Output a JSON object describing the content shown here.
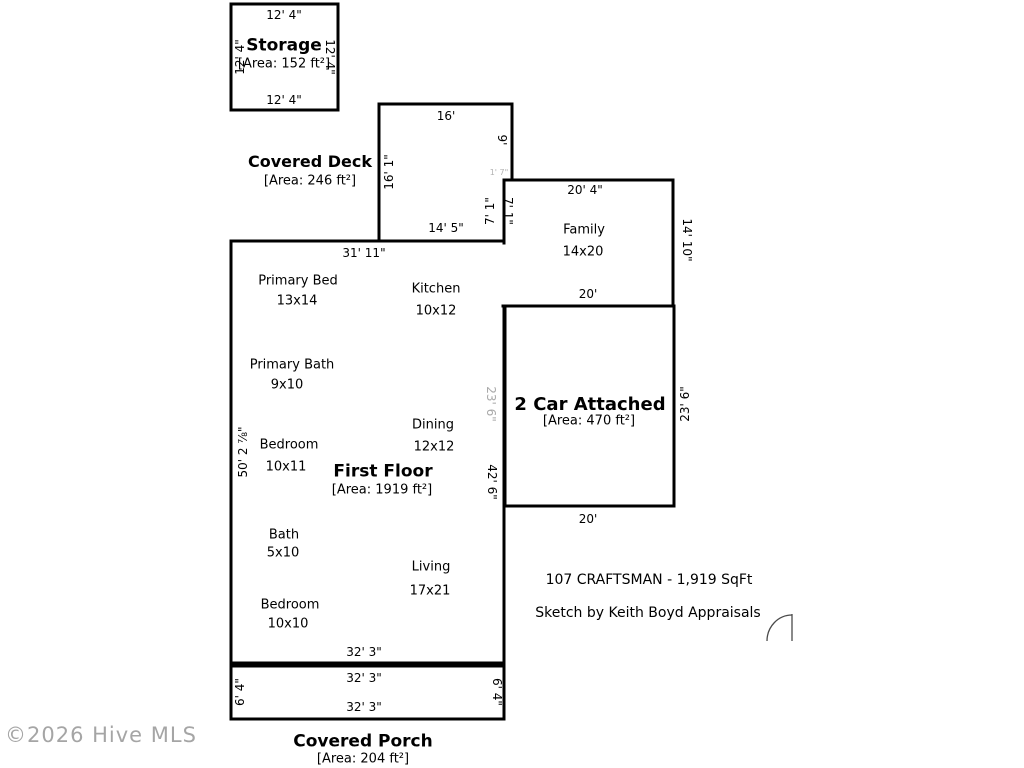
{
  "rooms": {
    "storage": {
      "name": "Storage",
      "area": "[Area: 152 ft²]"
    },
    "deck": {
      "name": "Covered Deck",
      "area": "[Area: 246 ft²]"
    },
    "first_floor": {
      "name": "First Floor",
      "area": "[Area: 1919 ft²]"
    },
    "garage": {
      "name": "2 Car Attached",
      "area": "[Area: 470 ft²]"
    },
    "porch": {
      "name": "Covered Porch",
      "area": "[Area: 204 ft²]"
    },
    "primary_bed": {
      "name": "Primary Bed",
      "size": "13x14"
    },
    "kitchen": {
      "name": "Kitchen",
      "size": "10x12"
    },
    "primary_bath": {
      "name": "Primary Bath",
      "size": "9x10"
    },
    "bedroom1": {
      "name": "Bedroom",
      "size": "10x11"
    },
    "dining": {
      "name": "Dining",
      "size": "12x12"
    },
    "bath": {
      "name": "Bath",
      "size": "5x10"
    },
    "living": {
      "name": "Living",
      "size": "17x21"
    },
    "bedroom2": {
      "name": "Bedroom",
      "size": "10x10"
    },
    "family": {
      "name": "Family",
      "size": "14x20"
    }
  },
  "dims": {
    "storage_top": "12' 4\"",
    "storage_bottom": "12' 4\"",
    "storage_left": "12' 4\"",
    "storage_right": "12' 4\"",
    "deck_top": "16'",
    "deck_left": "16' 1\"",
    "deck_bottom": "14' 5\"",
    "deck_right": "9'",
    "notch": "1' 7\"",
    "step_left": "7' 1\"",
    "step_right": "7' 1\"",
    "house_top": "31' 11\"",
    "house_left": "50' 2 ⅞\"",
    "house_bottom": "32' 3\"",
    "house_right": "42' 6\"",
    "family_top": "20' 4\"",
    "family_right": "14' 10\"",
    "family_bottom": "20'",
    "garage_left": "23' 6\"",
    "garage_right": "23' 6\"",
    "garage_bottom": "20'",
    "porch_top": "32' 3\"",
    "porch_bottom": "32' 3\"",
    "porch_left": "6' 4\"",
    "porch_right": "6' 4\""
  },
  "notes": {
    "line1": "107 CRAFTSMAN - 1,919 SqFt",
    "line2": "Sketch by Keith Boyd Appraisals"
  },
  "watermark": "©2026 Hive MLS",
  "colors": {
    "wall": "#000000",
    "gray_dim": "#a9a9a9",
    "watermark": "#969696"
  }
}
